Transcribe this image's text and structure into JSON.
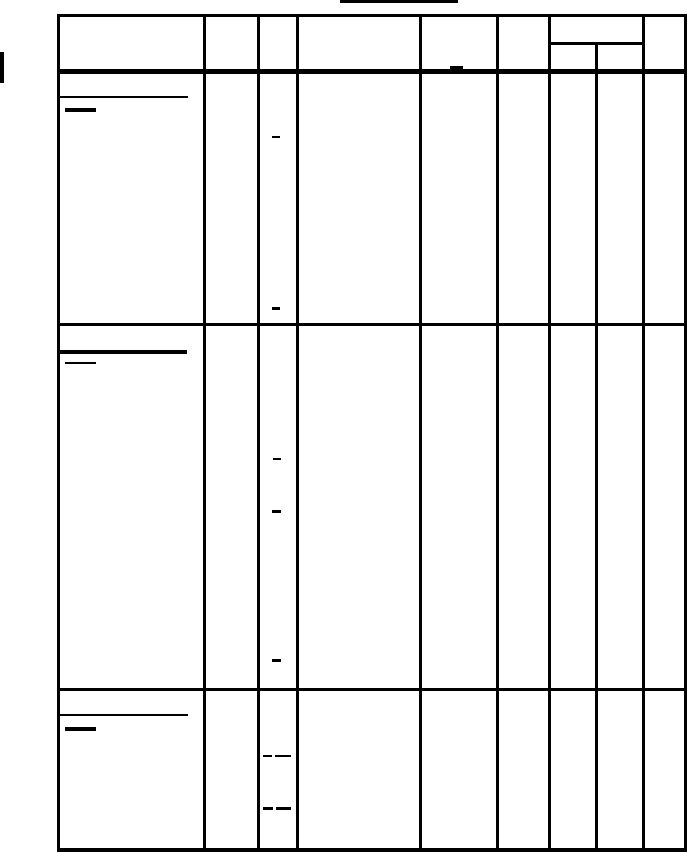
{
  "page": {
    "width": 688,
    "height": 853,
    "background_color": "#ffffff",
    "ink_color": "#000000"
  },
  "title": {
    "text": "",
    "underline": {
      "x": 340,
      "y": 0,
      "w": 118,
      "h": 3
    }
  },
  "scan_artifacts": [
    {
      "name": "left-margin-bar",
      "x": 0,
      "y": 52,
      "w": 4,
      "h": 31
    }
  ],
  "table": {
    "x": 57,
    "y": 14,
    "w": 630,
    "h": 837,
    "row_count": 3,
    "column_count": 9,
    "header": {
      "merged_cell_span": "columns 7-8",
      "all_cells_empty": true
    },
    "grid_lines": [
      {
        "name": "border-top",
        "x": 57,
        "y": 14,
        "w": 630,
        "h": 3
      },
      {
        "name": "border-bottom",
        "x": 57,
        "y": 848,
        "w": 630,
        "h": 4
      },
      {
        "name": "border-left",
        "x": 57,
        "y": 14,
        "w": 3,
        "h": 838
      },
      {
        "name": "border-right",
        "x": 684,
        "y": 14,
        "w": 3,
        "h": 838
      },
      {
        "name": "col-line-1",
        "x": 203,
        "y": 14,
        "w": 3,
        "h": 837
      },
      {
        "name": "col-line-2",
        "x": 257,
        "y": 14,
        "w": 3,
        "h": 837
      },
      {
        "name": "col-line-3",
        "x": 296,
        "y": 14,
        "w": 3,
        "h": 837
      },
      {
        "name": "col-line-4",
        "x": 419,
        "y": 14,
        "w": 3,
        "h": 837
      },
      {
        "name": "col-line-5",
        "x": 496,
        "y": 14,
        "w": 3,
        "h": 837
      },
      {
        "name": "col-line-6",
        "x": 548,
        "y": 14,
        "w": 3,
        "h": 837
      },
      {
        "name": "col-line-7-sub",
        "x": 595,
        "y": 43,
        "w": 3,
        "h": 808
      },
      {
        "name": "col-line-8",
        "x": 642,
        "y": 14,
        "w": 3,
        "h": 837
      },
      {
        "name": "header-bottom-thick",
        "x": 57,
        "y": 69,
        "w": 630,
        "h": 5
      },
      {
        "name": "header-subsplit",
        "x": 548,
        "y": 42,
        "w": 97,
        "h": 3
      },
      {
        "name": "row1-separator",
        "x": 57,
        "y": 323,
        "w": 630,
        "h": 3
      },
      {
        "name": "row2-separator",
        "x": 57,
        "y": 688,
        "w": 630,
        "h": 3
      }
    ],
    "ink_marks": [
      {
        "name": "header-col5-dash",
        "x": 450,
        "y": 66,
        "w": 13,
        "h": 3
      },
      {
        "name": "row1-long-underline",
        "x": 59,
        "y": 96,
        "w": 129,
        "h": 2
      },
      {
        "name": "row1-short-underline",
        "x": 65,
        "y": 108,
        "w": 31,
        "h": 4
      },
      {
        "name": "row1-col3-dash-a",
        "x": 272,
        "y": 136,
        "w": 8,
        "h": 2
      },
      {
        "name": "row1-col3-dash-b",
        "x": 272,
        "y": 307,
        "w": 8,
        "h": 3
      },
      {
        "name": "row2-long-underline",
        "x": 58,
        "y": 350,
        "w": 129,
        "h": 4
      },
      {
        "name": "row2-short-underline",
        "x": 65,
        "y": 362,
        "w": 31,
        "h": 2
      },
      {
        "name": "row2-col3-dash-a",
        "x": 273,
        "y": 458,
        "w": 8,
        "h": 2
      },
      {
        "name": "row2-col3-dash-b",
        "x": 272,
        "y": 510,
        "w": 9,
        "h": 3
      },
      {
        "name": "row2-col3-dash-c",
        "x": 272,
        "y": 659,
        "w": 9,
        "h": 3
      },
      {
        "name": "row3-long-underline",
        "x": 59,
        "y": 714,
        "w": 129,
        "h": 2
      },
      {
        "name": "row3-short-underline",
        "x": 65,
        "y": 727,
        "w": 31,
        "h": 4
      },
      {
        "name": "row3-col3-dash-pair1-a",
        "x": 263,
        "y": 755,
        "w": 9,
        "h": 2
      },
      {
        "name": "row3-col3-dash-pair1-b",
        "x": 275,
        "y": 755,
        "w": 16,
        "h": 2
      },
      {
        "name": "row3-col3-dash-pair2-a",
        "x": 263,
        "y": 807,
        "w": 10,
        "h": 3
      },
      {
        "name": "row3-col3-dash-pair2-b",
        "x": 276,
        "y": 807,
        "w": 15,
        "h": 3
      }
    ]
  }
}
